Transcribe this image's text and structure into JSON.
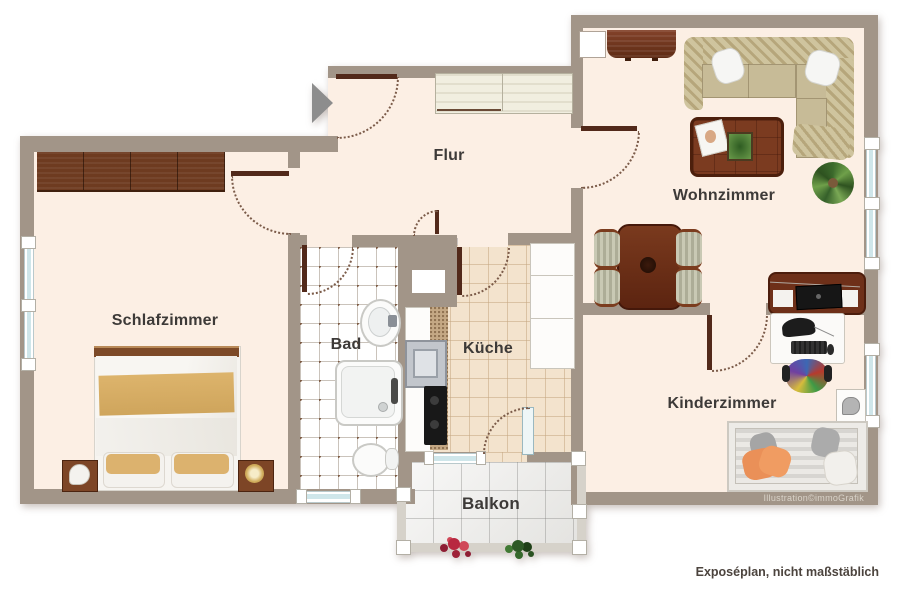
{
  "plan": {
    "type": "apartment-floorplan",
    "rooms": [
      {
        "id": "schlafzimmer",
        "label": "Schlafzimmer"
      },
      {
        "id": "bad",
        "label": "Bad"
      },
      {
        "id": "flur",
        "label": "Flur"
      },
      {
        "id": "kueche",
        "label": "Küche"
      },
      {
        "id": "wohnzimmer",
        "label": "Wohnzimmer"
      },
      {
        "id": "kinderzimmer",
        "label": "Kinderzimmer"
      },
      {
        "id": "balkon",
        "label": "Balkon"
      }
    ],
    "icons": [
      "entry-arrow-icon",
      "double-bed",
      "nightstand-lamps",
      "wardrobe",
      "hall-cabinet",
      "washbasin",
      "shower",
      "toilet",
      "kitchen-sink",
      "stove",
      "kitchen-cabinets",
      "corner-sofa",
      "coffee-table",
      "dining-table-with-chairs",
      "sideboard",
      "tv-lowboard",
      "desk-with-computer",
      "office-chair",
      "single-bed",
      "potted-plant",
      "balcony-flowers"
    ]
  },
  "annotations": {
    "credit": "Illustration©immoGrafik",
    "disclaimer": "Exposéplan, nicht maßstäblich"
  },
  "colors": {
    "wall": "#a29588",
    "floor": "#fcefe4",
    "kitchen_tile": "#f3e3cd",
    "balcony_tile": "#eeedeb",
    "bath_dot": "#7d5a44",
    "window_glass": "#cfe6ea",
    "door_arc": "#7b5b49",
    "door_leaf": "#52291a",
    "label_text": "#3d3a38",
    "credit_text": "#d9d3c9",
    "disclaimer_text": "#4c443e",
    "arrow": "#8d8d8d"
  }
}
